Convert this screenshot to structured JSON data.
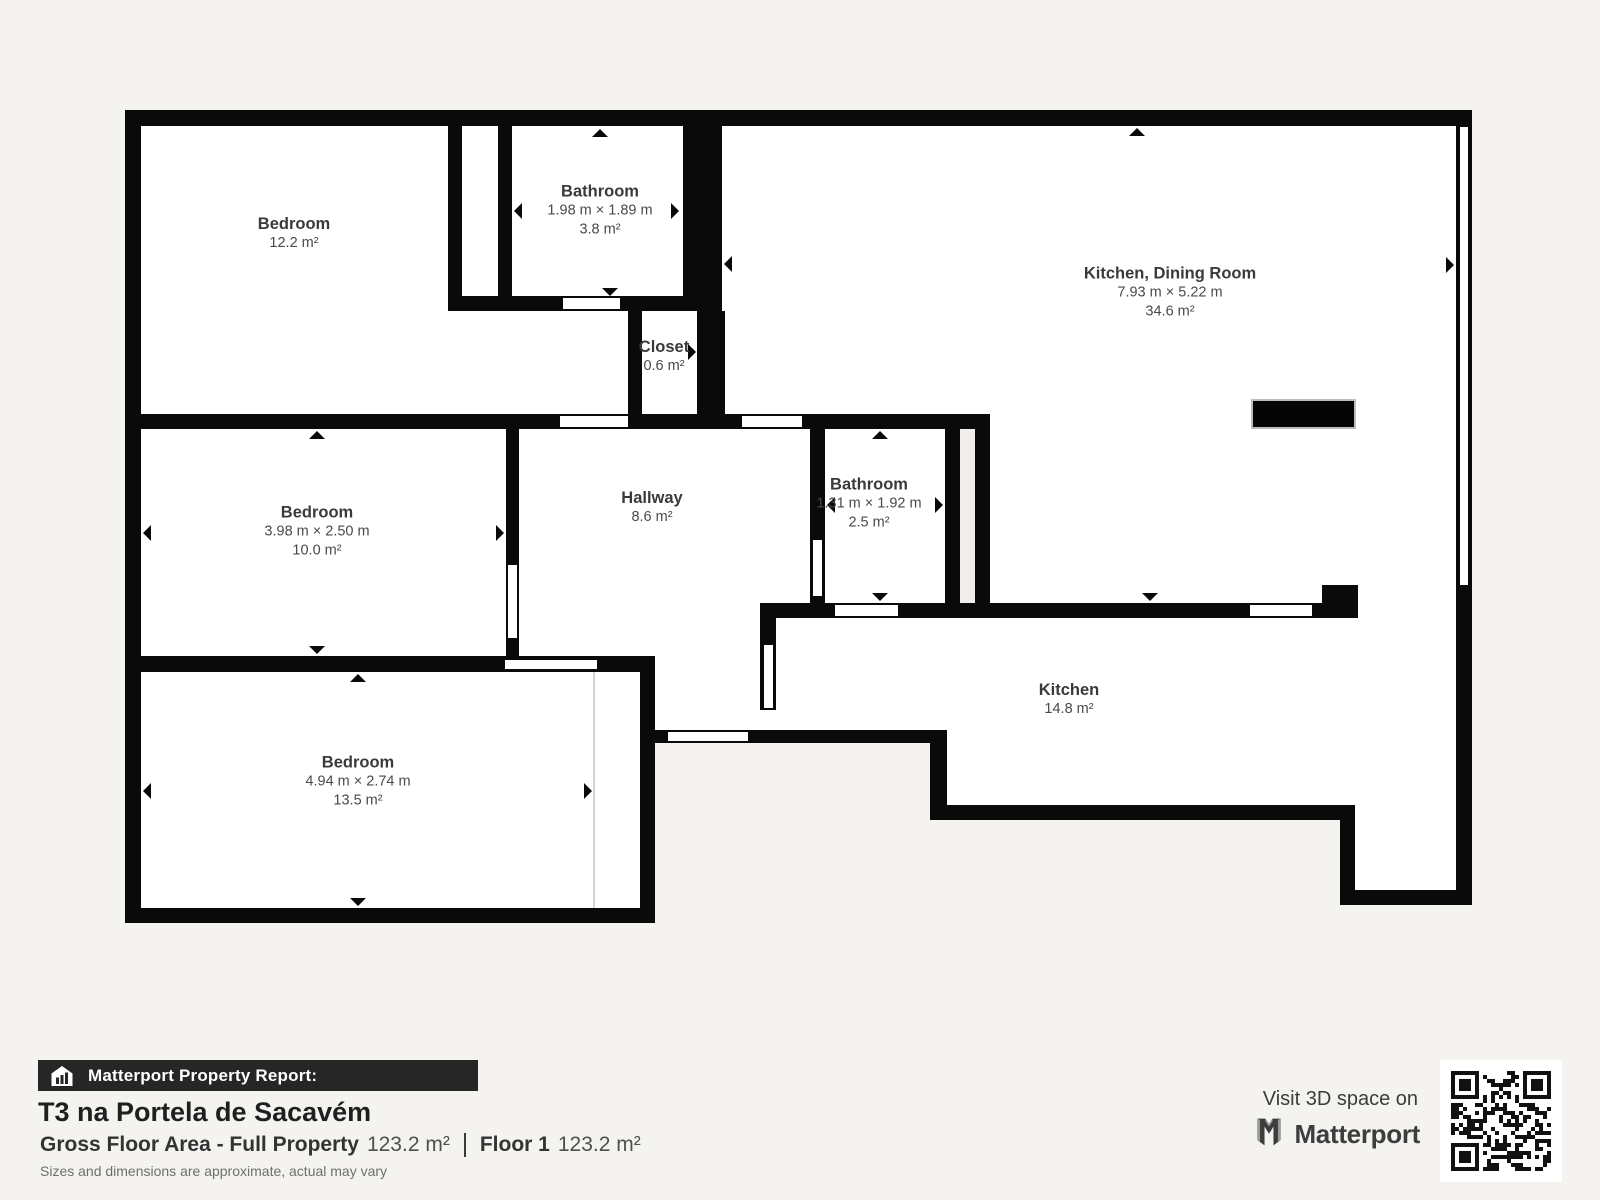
{
  "floor_plan": {
    "rooms": [
      {
        "name": "Bedroom",
        "dims": "",
        "area": "12.2 m²"
      },
      {
        "name": "Bathroom",
        "dims": "1.98 m × 1.89 m",
        "area": "3.8 m²"
      },
      {
        "name": "Kitchen, Dining Room",
        "dims": "7.93 m × 5.22 m",
        "area": "34.6 m²"
      },
      {
        "name": "Closet",
        "dims": "",
        "area": "0.6 m²"
      },
      {
        "name": "Bedroom",
        "dims": "3.98 m × 2.50 m",
        "area": "10.0 m²"
      },
      {
        "name": "Hallway",
        "dims": "",
        "area": "8.6 m²"
      },
      {
        "name": "Bathroom",
        "dims": "1.31 m × 1.92 m",
        "area": "2.5 m²"
      },
      {
        "name": "Bedroom",
        "dims": "4.94 m × 2.74 m",
        "area": "13.5 m²"
      },
      {
        "name": "Kitchen",
        "dims": "",
        "area": "14.8 m²"
      }
    ]
  },
  "report": {
    "bar_label": "Matterport Property Report:",
    "property_title": "T3 na Portela de Sacavém",
    "gross_label": "Gross Floor Area - Full Property",
    "gross_value": "123.2 m²",
    "floor_label": "Floor 1",
    "floor_value": "123.2 m²",
    "disclaimer": "Sizes and dimensions are approximate, actual may vary"
  },
  "promo": {
    "visit_text": "Visit 3D space on",
    "brand": "Matterport"
  },
  "colors": {
    "wall": "#0a0a0a",
    "background": "#f4f3f0",
    "room_fill": "#ffffff",
    "shaft_fill": "#efeeeb",
    "bar_background": "#262626"
  }
}
